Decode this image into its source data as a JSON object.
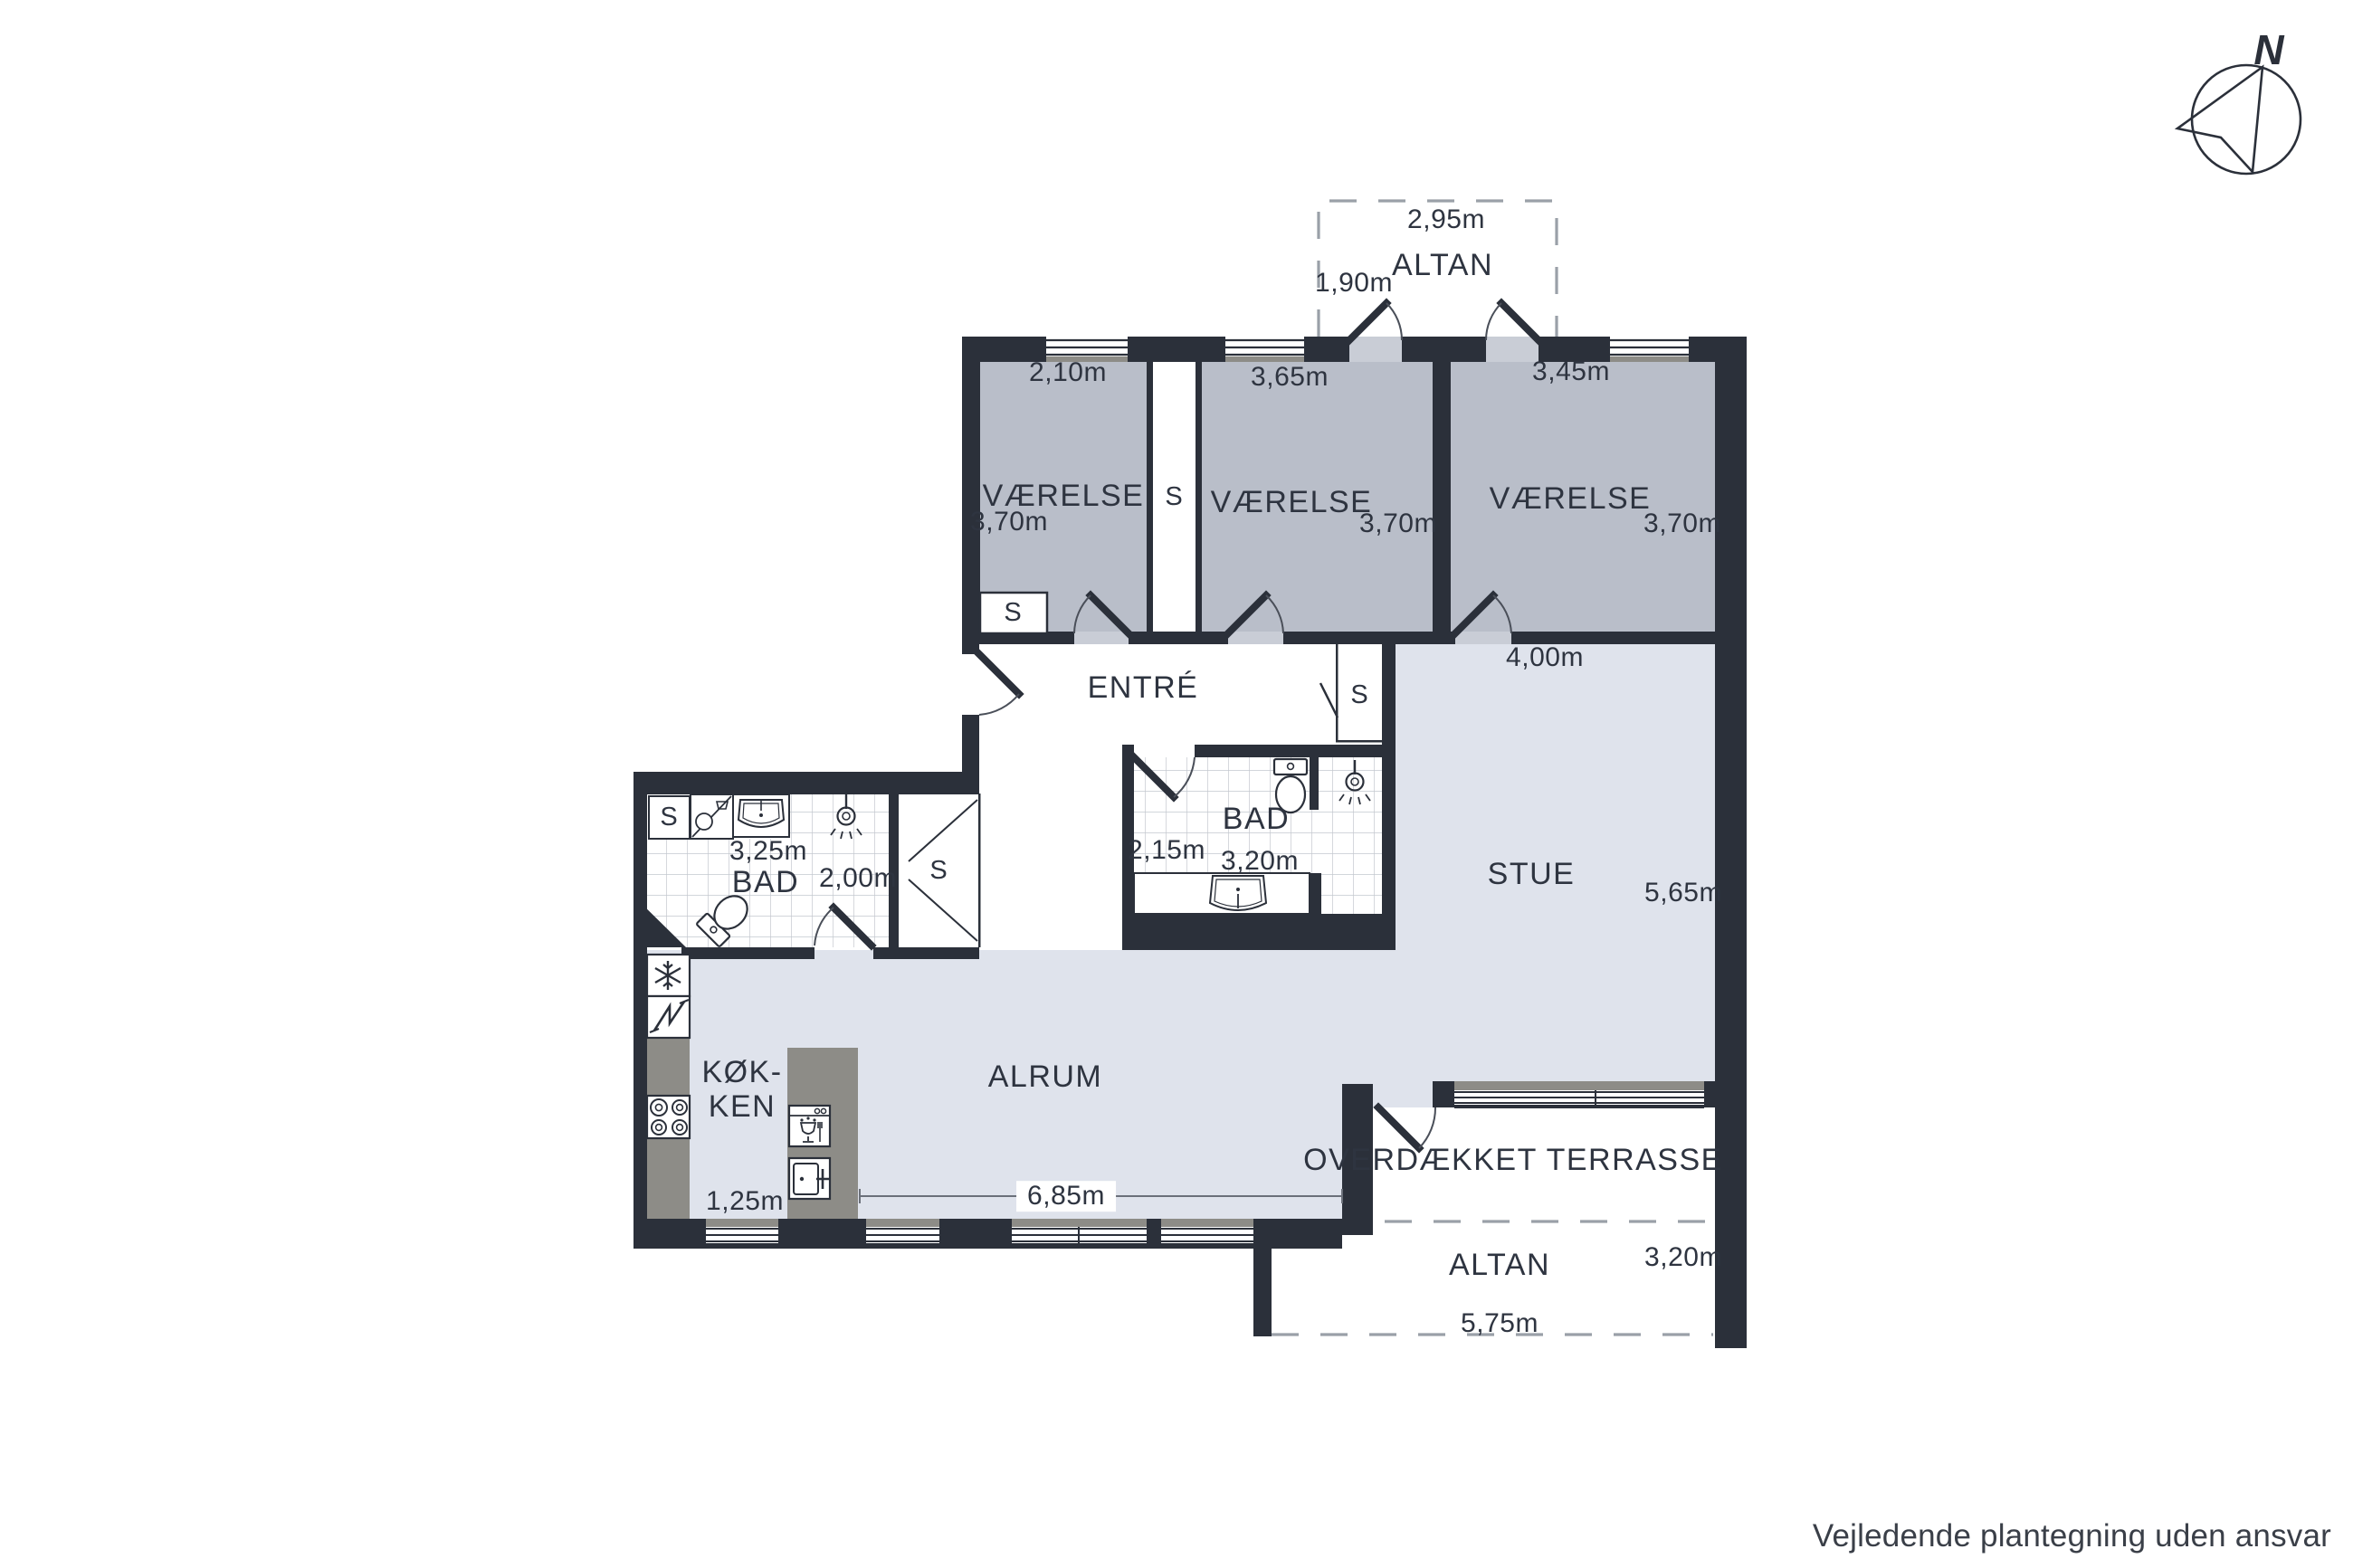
{
  "compass": {
    "north_label": "N"
  },
  "rooms": {
    "altan_top": {
      "label": "ALTAN"
    },
    "vaerelse1": {
      "label": "VÆRELSE"
    },
    "vaerelse2": {
      "label": "VÆRELSE"
    },
    "vaerelse3": {
      "label": "VÆRELSE"
    },
    "entre": {
      "label": "ENTRÉ"
    },
    "bad1": {
      "label": "BAD"
    },
    "bad2": {
      "label": "BAD"
    },
    "stue": {
      "label": "STUE"
    },
    "koekken": {
      "label": "KØK-\nKEN"
    },
    "alrum": {
      "label": "ALRUM"
    },
    "terrasse": {
      "label": "OVERDÆKKET TERRASSE"
    },
    "altan_bottom": {
      "label": "ALTAN"
    }
  },
  "closets": {
    "s_room1": "S",
    "s_mid": "S",
    "s_entre": "S",
    "s_hall": "S",
    "s_bad": "S"
  },
  "dims": {
    "alt_w": "2,95m",
    "alt_d": "1,90m",
    "r1_w": "2,10m",
    "r1_d": "3,70m",
    "r2_w": "3,65m",
    "r2_d": "3,70m",
    "r3_w": "3,45m",
    "r3_d": "3,70m",
    "stue_w": "4,00m",
    "stue_d": "5,65m",
    "bad1_w": "3,25m",
    "bad1_d": "2,00m",
    "bad2_d": "2,15m",
    "bad2_w": "3,20m",
    "kok_w": "1,25m",
    "alrum_w": "6,85m",
    "altan2_d": "3,20m",
    "altan2_w": "5,75m"
  },
  "footer": {
    "disclaimer": "Vejledende plantegning uden ansvar"
  },
  "colors": {
    "wall": "#2b303a",
    "bedroom_floor": "#b9bec9",
    "living_floor": "#dfe3ec",
    "counter_gray": "#8d8c87",
    "tile_line": "#c4c8cf",
    "dash_line": "#9aa0a8",
    "text": "#2e3440"
  },
  "icons": {
    "compass": "north-arrow-icon",
    "kitchen": [
      "freezer-snowflake-icon",
      "fridge-icon",
      "stove-burners-icon",
      "dishwasher-icon",
      "oven-icon"
    ],
    "bath": [
      "toilet-icon",
      "shower-icon",
      "sink-icon",
      "washing-machine-icon"
    ]
  }
}
